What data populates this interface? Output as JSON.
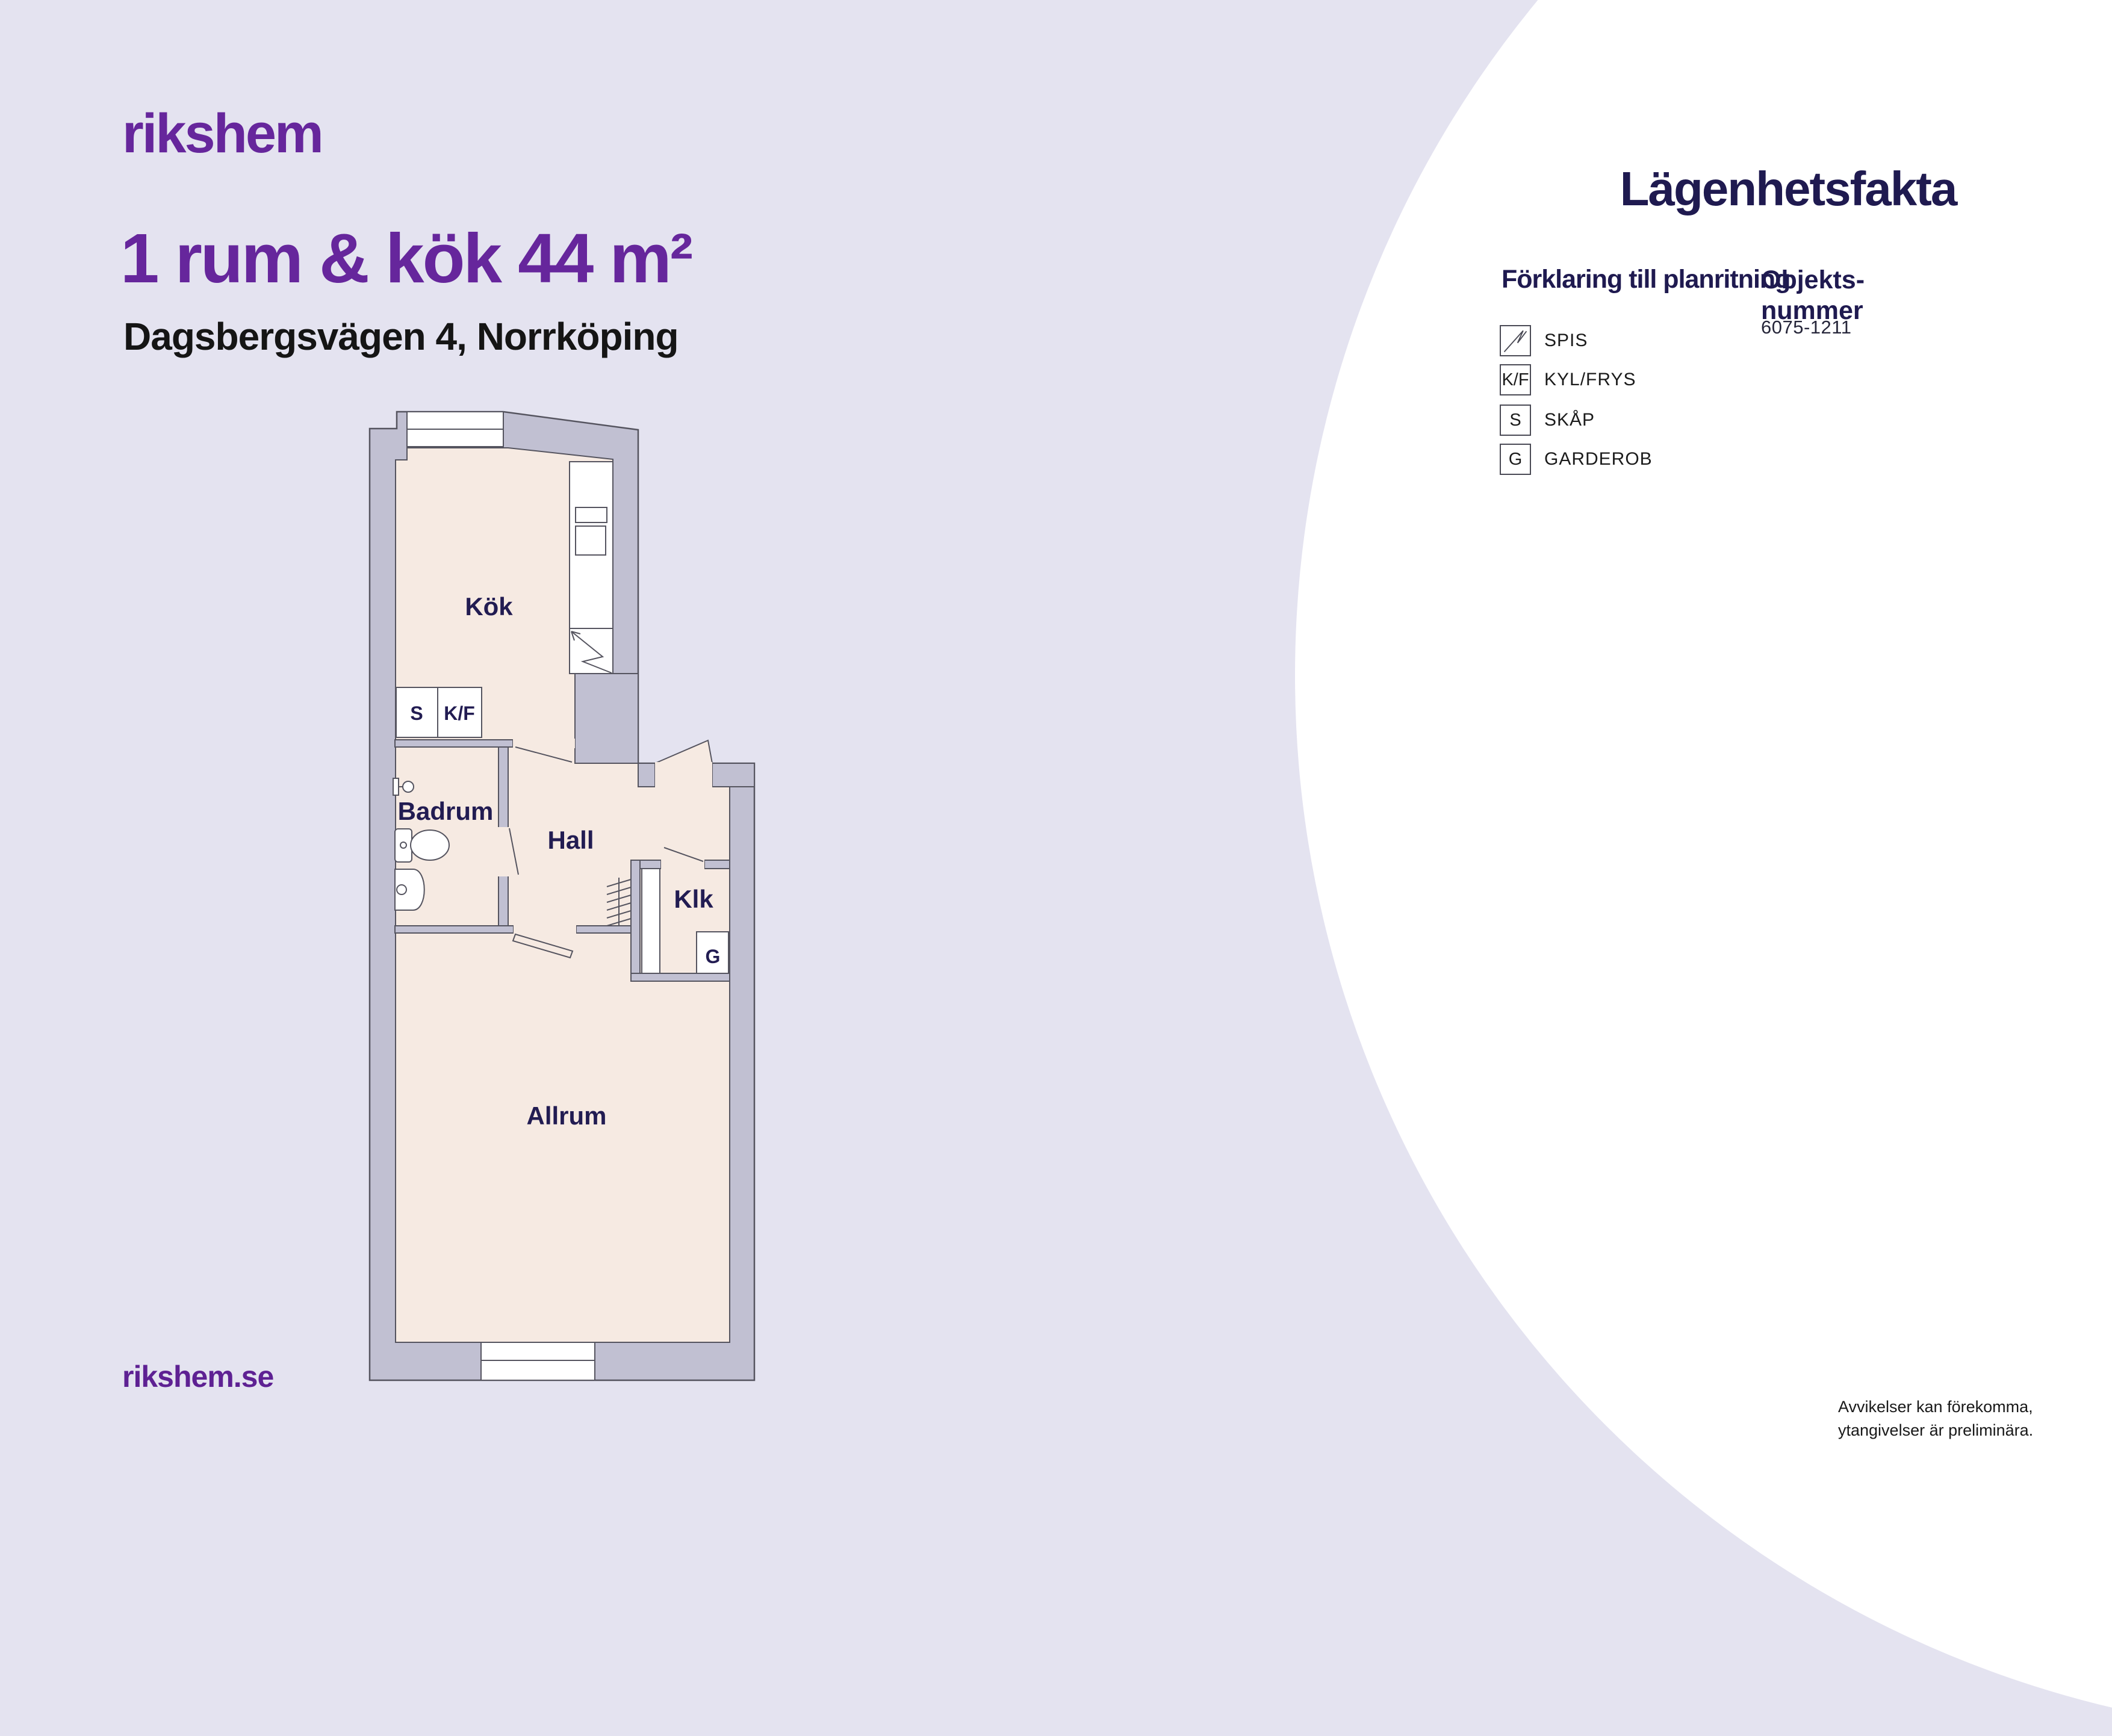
{
  "colors": {
    "background": "#E4E3F0",
    "panel_circle": "#FFFFFF",
    "brand_purple": "#66269C",
    "heading_navy": "#1F1A50",
    "wall_fill": "#C1C0D2",
    "wall_outline": "#55545F",
    "room_fill": "#F6EAE2",
    "text_dark": "#1A1A1A"
  },
  "header": {
    "logo_text": "rikshem",
    "title": "1 rum & kök 44 m²",
    "subtitle": "Dagsbergsvägen 4, Norrköping"
  },
  "facts_panel": {
    "heading": "Lägenhetsfakta",
    "legend_heading": "Förklaring till planritning",
    "object_label_line1": "Objekts-",
    "object_label_line2": "nummer",
    "object_number": "6075-1211",
    "legend": [
      {
        "symbol": "zigzag-stove-icon",
        "label": "SPIS"
      },
      {
        "symbol": "K/F",
        "label": "KYL/FRYS"
      },
      {
        "symbol": "S",
        "label": "SKÅP"
      },
      {
        "symbol": "G",
        "label": "GARDEROB"
      }
    ]
  },
  "floorplan": {
    "room_labels": {
      "kitchen": "Kök",
      "bathroom": "Badrum",
      "hall": "Hall",
      "closet": "Klk",
      "living_room": "Allrum"
    },
    "fixture_labels": {
      "cabinet": "S",
      "fridge_freezer": "K/F",
      "wardrobe": "G"
    }
  },
  "footer": {
    "website": "rikshem.se",
    "disclaimer_line1": "Avvikelser kan förekomma,",
    "disclaimer_line2": "ytangivelser är preliminära."
  }
}
